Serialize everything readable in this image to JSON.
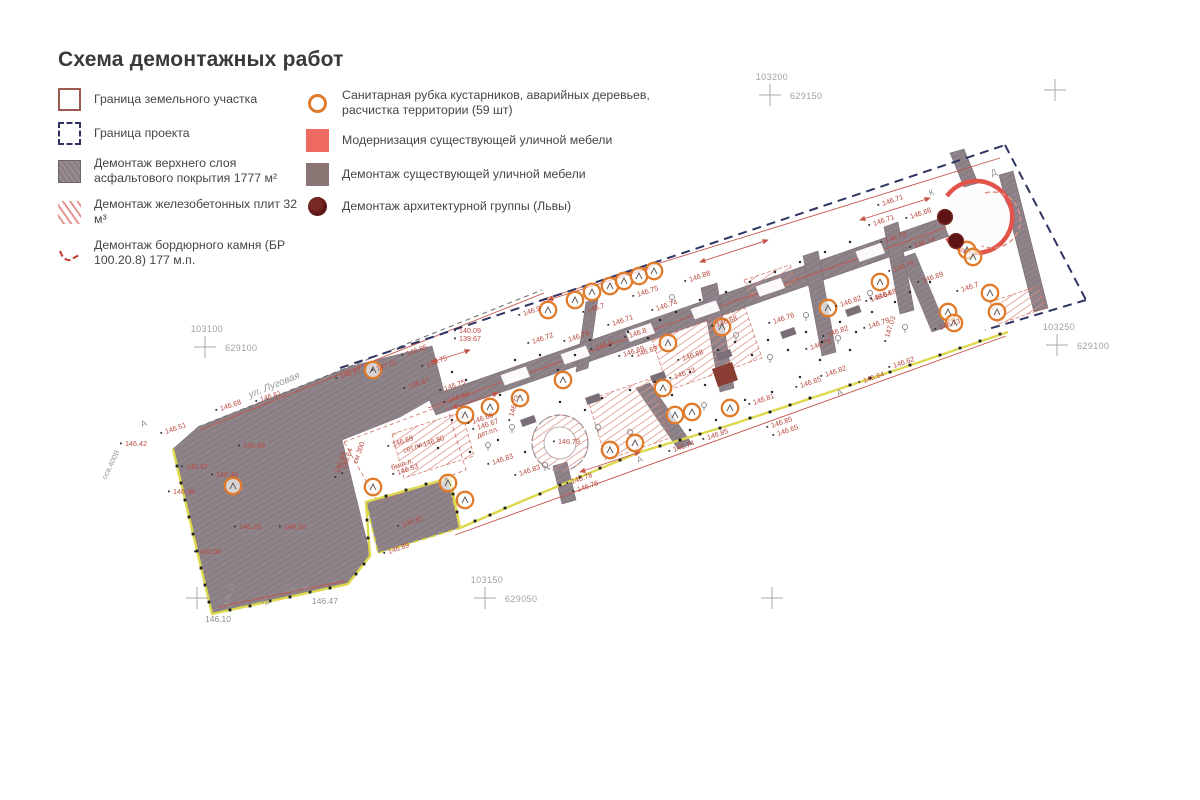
{
  "title": "Схема демонтажных работ",
  "legend": {
    "left": [
      {
        "label": "Граница земельного участка",
        "symbol": "land-boundary"
      },
      {
        "label": "Граница проекта",
        "symbol": "project-boundary"
      },
      {
        "label": "Демонтаж верхнего слоя асфальтового покрытия 1777 м²",
        "symbol": "asphalt-demolition"
      },
      {
        "label": "Демонтаж железобетонных плит 32 м³",
        "symbol": "concrete-slabs-demolition"
      },
      {
        "label": "Демонтаж бордюрного камня (БР 100.20.8) 177 м.п.",
        "symbol": "curb-demolition"
      }
    ],
    "right": [
      {
        "label": "Санитарная рубка кустарников, аварийных деревьев, расчистка территории (59 шт)",
        "symbol": "sanitary-cutting"
      },
      {
        "label": "Модернизация существующей уличной мебели",
        "symbol": "furniture-modernization"
      },
      {
        "label": "Демонтаж существующей уличной мебели",
        "symbol": "furniture-demolition"
      },
      {
        "label": "Демонтаж архитектурной группы (Львы)",
        "symbol": "lions-demolition"
      }
    ]
  },
  "colors": {
    "accent_red": "#c0392b",
    "navy_boundary": "#2f3563",
    "yellow_boundary": "#ddd84c",
    "asphalt_gray": "#8b7f86",
    "orange_tree": "#df7b2b",
    "salmon": "#ee6a60",
    "maroon_lion": "#5c1514",
    "hatch_red": "#dc9188"
  },
  "plan": {
    "crosses": [
      {
        "x": 770,
        "y": 95,
        "top": "103200",
        "right": "629150"
      },
      {
        "x": 1055,
        "y": 90
      },
      {
        "x": 205,
        "y": 347,
        "top": "103100",
        "right": "629100"
      },
      {
        "x": 1057,
        "y": 345,
        "top": "103250",
        "right": "629100"
      },
      {
        "x": 485,
        "y": 598,
        "top": "103150",
        "right": "629050"
      },
      {
        "x": 772,
        "y": 598
      },
      {
        "x": 197,
        "y": 598
      }
    ],
    "street_label": "ул. Луговая",
    "texts": [
      [
        250,
        398,
        "ул. Луговая",
        -22,
        "t10g"
      ],
      [
        106,
        480,
        "осв.400В",
        -64,
        "t8g"
      ],
      [
        142,
        427,
        "А",
        -20,
        "t9g"
      ],
      [
        638,
        463,
        "А",
        -20,
        "t9g"
      ],
      [
        838,
        396,
        "А",
        -20,
        "t9g"
      ],
      [
        930,
        196,
        "К",
        -20,
        "t9g"
      ],
      [
        992,
        176,
        "Д",
        -20,
        "t9g"
      ],
      [
        262,
        604,
        "гр",
        0,
        "t9g"
      ],
      [
        284,
        592,
        "146.30",
        0,
        "t9g"
      ],
      [
        312,
        604,
        "146.47",
        0,
        "t9g"
      ],
      [
        205,
        622,
        "146.10",
        0,
        "t9g"
      ],
      [
        228,
        606,
        "146.15",
        -72,
        "t8g"
      ],
      [
        478,
        438,
        "дет.пл.",
        -19,
        "t8r"
      ],
      [
        357,
        464,
        "см 300",
        -70,
        "t8r"
      ],
      [
        392,
        470,
        "бм п.л.",
        -19,
        "t8r"
      ],
      [
        404,
        453,
        "сет.пл.",
        -19,
        "t8r"
      ]
    ],
    "elevations": [
      [
        407,
        356,
        "146.85"
      ],
      [
        377,
        371,
        "147.01"
      ],
      [
        341,
        379,
        "146.87"
      ],
      [
        409,
        389,
        "146.67"
      ],
      [
        445,
        391,
        "146.75"
      ],
      [
        449,
        403,
        "146.84"
      ],
      [
        473,
        424,
        "146.66"
      ],
      [
        478,
        430,
        "146.67"
      ],
      [
        393,
        447,
        "146.69"
      ],
      [
        424,
        447,
        "146.80"
      ],
      [
        520,
        476,
        "146.83"
      ],
      [
        493,
        465,
        "146.83"
      ],
      [
        346,
        470,
        "146.64",
        -72
      ],
      [
        398,
        475,
        "146.53"
      ],
      [
        558,
        444,
        "146.79",
        0
      ],
      [
        513,
        417,
        "146.73",
        -72
      ],
      [
        459,
        333,
        "140.09",
        0
      ],
      [
        459,
        341,
        "139.67",
        0
      ],
      [
        524,
        316,
        "146.9"
      ],
      [
        588,
        313,
        "146.7"
      ],
      [
        638,
        297,
        "146.75"
      ],
      [
        657,
        311,
        "146.74"
      ],
      [
        613,
        326,
        "146.71"
      ],
      [
        569,
        342,
        "146.79"
      ],
      [
        596,
        350,
        "146.8"
      ],
      [
        624,
        357,
        "146.69"
      ],
      [
        427,
        367,
        "146.75"
      ],
      [
        533,
        344,
        "146.72"
      ],
      [
        690,
        282,
        "146.88"
      ],
      [
        841,
        307,
        "146.82"
      ],
      [
        871,
        302,
        "146.64"
      ],
      [
        774,
        324,
        "146.76"
      ],
      [
        828,
        337,
        "146.82"
      ],
      [
        869,
        329,
        "146.79"
      ],
      [
        811,
        350,
        "146.79"
      ],
      [
        826,
        377,
        "146.82"
      ],
      [
        801,
        388,
        "146.65"
      ],
      [
        754,
        405,
        "146.81"
      ],
      [
        683,
        361,
        "146.68"
      ],
      [
        675,
        379,
        "146.73"
      ],
      [
        864,
        383,
        "146.64"
      ],
      [
        894,
        368,
        "146.62"
      ],
      [
        889,
        338,
        "147.03",
        -72
      ],
      [
        772,
        428,
        "146.85"
      ],
      [
        778,
        436,
        "146.65"
      ],
      [
        708,
        440,
        "146.85"
      ],
      [
        674,
        452,
        "146.74"
      ],
      [
        572,
        484,
        "146.78"
      ],
      [
        578,
        492,
        "146.76"
      ],
      [
        883,
        206,
        "146.71"
      ],
      [
        874,
        226,
        "146.71"
      ],
      [
        911,
        219,
        "146.66"
      ],
      [
        886,
        243,
        "146.78"
      ],
      [
        915,
        248,
        "146.74"
      ],
      [
        894,
        272,
        "146.75"
      ],
      [
        923,
        283,
        "146.69"
      ],
      [
        876,
        300,
        "146.68"
      ],
      [
        962,
        292,
        "146.7"
      ],
      [
        940,
        330,
        "146.73"
      ],
      [
        125,
        446,
        "146.42",
        0
      ],
      [
        166,
        434,
        "146.51"
      ],
      [
        221,
        411,
        "146.68"
      ],
      [
        261,
        402,
        "146.61"
      ],
      [
        243,
        448,
        "146.48",
        0
      ],
      [
        186,
        469,
        "146.47",
        0
      ],
      [
        216,
        477,
        "146.46",
        0
      ],
      [
        173,
        494,
        "146.36",
        0
      ],
      [
        239,
        529,
        "146.26",
        0
      ],
      [
        284,
        529,
        "146.32",
        0
      ],
      [
        199,
        554,
        "146.08",
        0
      ],
      [
        389,
        554,
        "146.89"
      ],
      [
        403,
        527,
        "146.81"
      ],
      [
        339,
        474,
        "146.64",
        -72
      ],
      [
        630,
        338,
        "146.8"
      ],
      [
        637,
        357,
        "146.69"
      ],
      [
        717,
        327,
        "146.68"
      ]
    ],
    "trees": [
      [
        548,
        310
      ],
      [
        575,
        300
      ],
      [
        592,
        292
      ],
      [
        610,
        286
      ],
      [
        624,
        281
      ],
      [
        639,
        276
      ],
      [
        654,
        271
      ],
      [
        233,
        486
      ],
      [
        373,
        370
      ],
      [
        465,
        415
      ],
      [
        490,
        407
      ],
      [
        520,
        398
      ],
      [
        563,
        380
      ],
      [
        448,
        483
      ],
      [
        465,
        500
      ],
      [
        373,
        487
      ],
      [
        610,
        450
      ],
      [
        635,
        443
      ],
      [
        668,
        343
      ],
      [
        722,
        327
      ],
      [
        828,
        308
      ],
      [
        663,
        388
      ],
      [
        675,
        415
      ],
      [
        692,
        412
      ],
      [
        730,
        408
      ],
      [
        880,
        282
      ],
      [
        967,
        250
      ],
      [
        973,
        257
      ],
      [
        990,
        293
      ],
      [
        948,
        312
      ],
      [
        954,
        323
      ],
      [
        997,
        312
      ]
    ],
    "small_trees": [
      [
        630,
        435
      ],
      [
        704,
        408
      ],
      [
        545,
        468
      ],
      [
        598,
        430
      ],
      [
        488,
        448
      ],
      [
        672,
        300
      ],
      [
        736,
        338
      ],
      [
        806,
        318
      ],
      [
        870,
        296
      ],
      [
        918,
        272
      ],
      [
        770,
        360
      ],
      [
        838,
        341
      ],
      [
        905,
        330
      ],
      [
        512,
        430
      ]
    ],
    "lions": [
      [
        945,
        217
      ],
      [
        956,
        241
      ]
    ],
    "benches": [
      [
        520,
        420
      ],
      [
        585,
        398
      ],
      [
        650,
        376
      ],
      [
        716,
        354
      ],
      [
        780,
        332
      ],
      [
        845,
        310
      ]
    ],
    "inset_x": [
      500,
      560,
      625,
      690,
      755,
      855
    ],
    "dim_arrows": [
      [
        548,
        300,
        650,
        268
      ],
      [
        700,
        262,
        768,
        240
      ],
      [
        860,
        220,
        930,
        198
      ],
      [
        432,
        362,
        470,
        350
      ],
      [
        580,
        472,
        640,
        452
      ],
      [
        452,
        408,
        498,
        393
      ]
    ],
    "survey_dots": [
      [
        452,
        372
      ],
      [
        466,
        380
      ],
      [
        500,
        395
      ],
      [
        515,
        360
      ],
      [
        540,
        355
      ],
      [
        558,
        370
      ],
      [
        575,
        355
      ],
      [
        590,
        340
      ],
      [
        610,
        345
      ],
      [
        628,
        332
      ],
      [
        648,
        338
      ],
      [
        560,
        402
      ],
      [
        585,
        410
      ],
      [
        602,
        398
      ],
      [
        630,
        390
      ],
      [
        655,
        382
      ],
      [
        672,
        395
      ],
      [
        690,
        372
      ],
      [
        705,
        385
      ],
      [
        718,
        350
      ],
      [
        735,
        342
      ],
      [
        752,
        355
      ],
      [
        768,
        340
      ],
      [
        788,
        350
      ],
      [
        806,
        332
      ],
      [
        822,
        342
      ],
      [
        840,
        322
      ],
      [
        856,
        332
      ],
      [
        872,
        312
      ],
      [
        895,
        302
      ],
      [
        910,
        292
      ],
      [
        930,
        282
      ],
      [
        700,
        412
      ],
      [
        716,
        420
      ],
      [
        745,
        400
      ],
      [
        772,
        392
      ],
      [
        800,
        377
      ],
      [
        452,
        420
      ],
      [
        438,
        448
      ],
      [
        470,
        452
      ],
      [
        498,
        440
      ],
      [
        525,
        452
      ],
      [
        690,
        430
      ],
      [
        820,
        360
      ],
      [
        850,
        350
      ],
      [
        660,
        320
      ],
      [
        676,
        312
      ],
      [
        700,
        300
      ],
      [
        726,
        292
      ],
      [
        750,
        282
      ],
      [
        775,
        272
      ],
      [
        800,
        262
      ],
      [
        825,
        252
      ],
      [
        850,
        242
      ]
    ],
    "boundary_dots": [
      [
        177,
        466
      ],
      [
        181,
        483
      ],
      [
        185,
        500
      ],
      [
        189,
        517
      ],
      [
        193,
        534
      ],
      [
        197,
        551
      ],
      [
        201,
        568
      ],
      [
        205,
        585
      ],
      [
        209,
        602
      ],
      [
        230,
        610
      ],
      [
        250,
        606
      ],
      [
        270,
        601
      ],
      [
        290,
        597
      ],
      [
        310,
        592
      ],
      [
        330,
        588
      ],
      [
        356,
        574
      ],
      [
        364,
        564
      ],
      [
        368,
        538
      ],
      [
        367,
        520
      ],
      [
        386,
        496
      ],
      [
        406,
        490
      ],
      [
        426,
        484
      ],
      [
        446,
        479
      ],
      [
        453,
        494
      ],
      [
        457,
        512
      ],
      [
        475,
        521
      ],
      [
        490,
        515
      ],
      [
        505,
        508
      ],
      [
        540,
        494
      ],
      [
        560,
        485
      ],
      [
        580,
        477
      ],
      [
        600,
        468
      ],
      [
        620,
        460
      ],
      [
        660,
        446
      ],
      [
        680,
        440
      ],
      [
        700,
        434
      ],
      [
        720,
        428
      ],
      [
        750,
        418
      ],
      [
        770,
        412
      ],
      [
        790,
        405
      ],
      [
        810,
        398
      ],
      [
        850,
        385
      ],
      [
        870,
        378
      ],
      [
        890,
        372
      ],
      [
        910,
        365
      ],
      [
        940,
        355
      ],
      [
        960,
        348
      ],
      [
        980,
        341
      ],
      [
        1000,
        334
      ]
    ]
  }
}
